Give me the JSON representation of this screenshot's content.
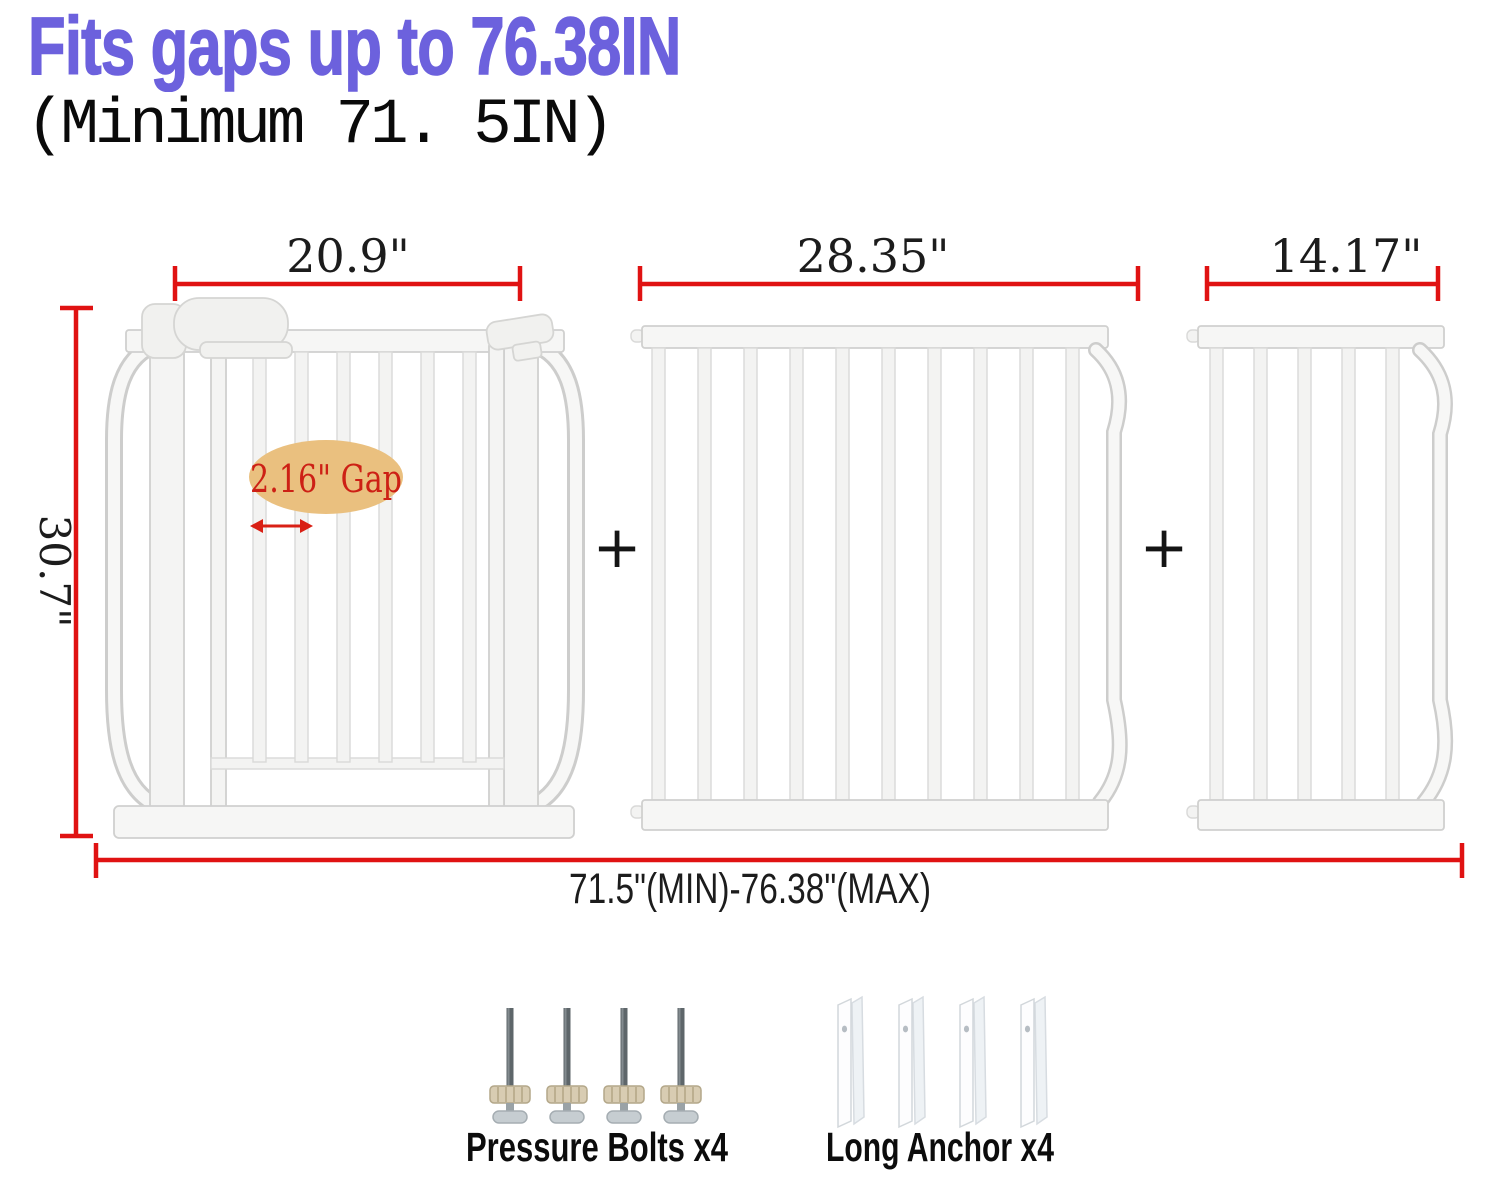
{
  "header": {
    "title": "Fits gaps up to 76.38IN",
    "subtitle": "(Minimum 71. 5IN)"
  },
  "annotations": {
    "left_panel_width": "20.9\"",
    "middle_panel_width": "28.35\"",
    "right_panel_width": "14.17\"",
    "gate_height": "30.7\"",
    "total_width_range": "71.5\"(MIN)-76.38\"(MAX)",
    "bar_gap": "2.16\" Gap",
    "plus": "+"
  },
  "hardware": {
    "pressure_bolts_label": "Pressure Bolts x4",
    "long_anchor_label": "Long Anchor x4"
  },
  "colors": {
    "title_text": "#6c61dd",
    "dimension_red": "#e01212",
    "gap_badge_fill": "#eac07f",
    "gap_text_red": "#cd2015",
    "gate_outline": "#d0d0cf",
    "gate_fill": "#f6f6f5",
    "bolt_rod_gray": "#5e666a",
    "bolt_nut_tan": "#d8ccb2"
  }
}
